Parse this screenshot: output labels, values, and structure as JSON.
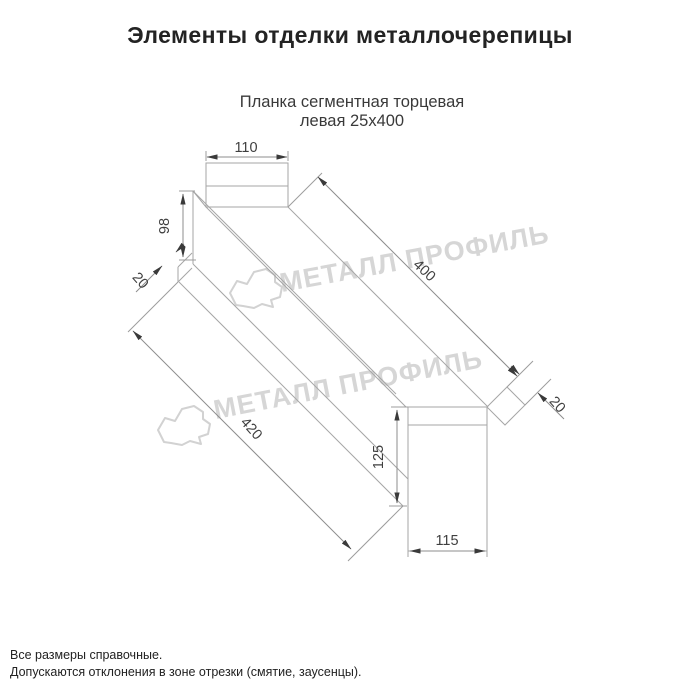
{
  "page": {
    "title": "Элементы отделки металлочерепицы",
    "subtitle_line1": "Планка сегментная торцевая",
    "subtitle_line2": "левая 25х400"
  },
  "drawing": {
    "kind": "technical-drawing",
    "part": "Планка сегментная торцевая левая 25х400",
    "dimensions": {
      "flange_top_width": "110",
      "web_height_top": "98",
      "hem_top": "20",
      "length_top_edge": "400",
      "length_bottom_edge": "420",
      "hem_end": "20",
      "end_height": "125",
      "end_width": "115"
    },
    "line_color": "#a6a6a6",
    "dim_color": "#3f3f3f"
  },
  "watermark": {
    "text": "МЕТАЛЛ ПРОФИЛЬ",
    "logo": "cloud-logo",
    "color": "#d6d6d6"
  },
  "footnotes": {
    "line1": "Все размеры справочные.",
    "line2": "Допускаются отклонения в зоне отрезки (смятие, заусенцы)."
  }
}
